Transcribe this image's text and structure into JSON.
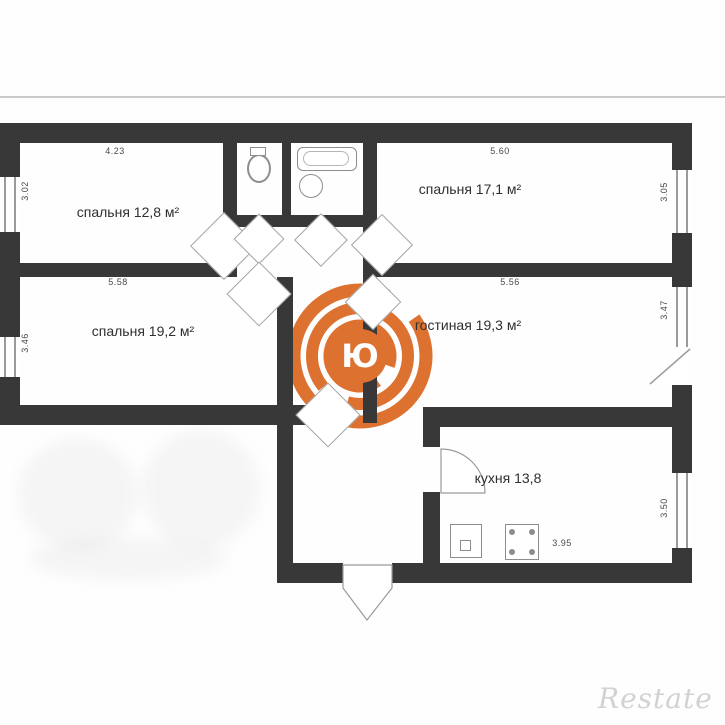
{
  "plan": {
    "rooms": [
      {
        "key": "bedroom-1",
        "label": "спальня 12,8 м²",
        "dim_top": "4.23",
        "dim_side": "3.02"
      },
      {
        "key": "bedroom-2",
        "label": "спальня 17,1 м²",
        "dim_top": "5.60",
        "dim_side": "3.05"
      },
      {
        "key": "bedroom-3",
        "label": "спальня 19,2 м²",
        "dim_top": "5.58",
        "dim_side": "3.46"
      },
      {
        "key": "living-room",
        "label": "гостиная 19,3 м²",
        "dim_top": "5.56",
        "dim_side": "3.47"
      },
      {
        "key": "kitchen",
        "label": "кухня 13,8",
        "dim_bottom": "3.95",
        "dim_side": "3.50"
      }
    ],
    "colors": {
      "wall": "#383838",
      "logo_orange": "#dd7230",
      "dim_text": "#4a4a4a",
      "label_text": "#2f2f2f",
      "watermark_gray": "#d2d2d2"
    },
    "logo": {
      "letter": "Ю"
    },
    "watermark": {
      "text": "Restate"
    }
  }
}
